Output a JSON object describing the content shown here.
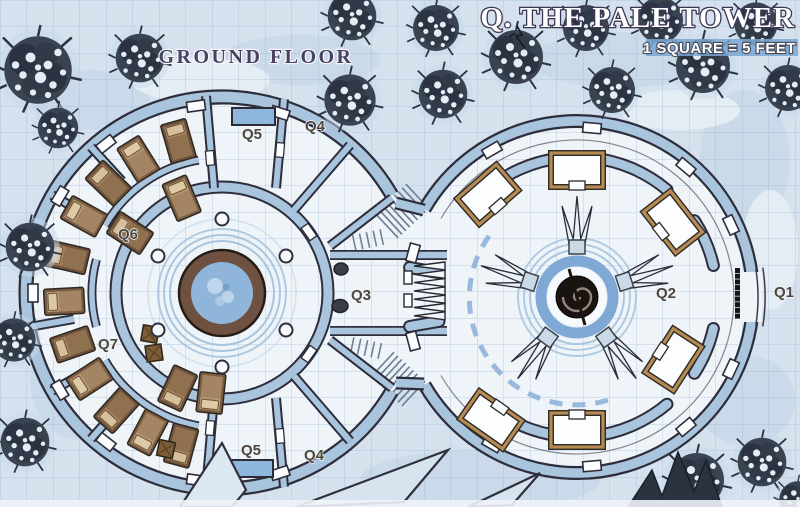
{
  "map": {
    "title": "Q. THE PALE TOWER",
    "scale_label": "1 SQUARE = 5 FEET",
    "floor_label": "GROUND FLOOR",
    "labels": {
      "q1": "Q1",
      "q2": "Q2",
      "q3": "Q3",
      "q4_top": "Q4",
      "q5_top": "Q5",
      "q4_bottom": "Q4",
      "q5_bottom": "Q5",
      "q6": "Q6",
      "q7": "Q7"
    },
    "colors": {
      "snow_bg": "#d5e2ee",
      "floor": "#eff4f9",
      "wall_fill": "#a9c4dd",
      "wall_outline": "#2e2d3c",
      "water": "#8fb6da",
      "wood": "#8a6a4f",
      "accent_blue": "#8fb3d8",
      "tree": "#39424f",
      "label_text": "#4d473e",
      "title_fill": "#ffffff",
      "title_outline": "#3b3654"
    }
  }
}
